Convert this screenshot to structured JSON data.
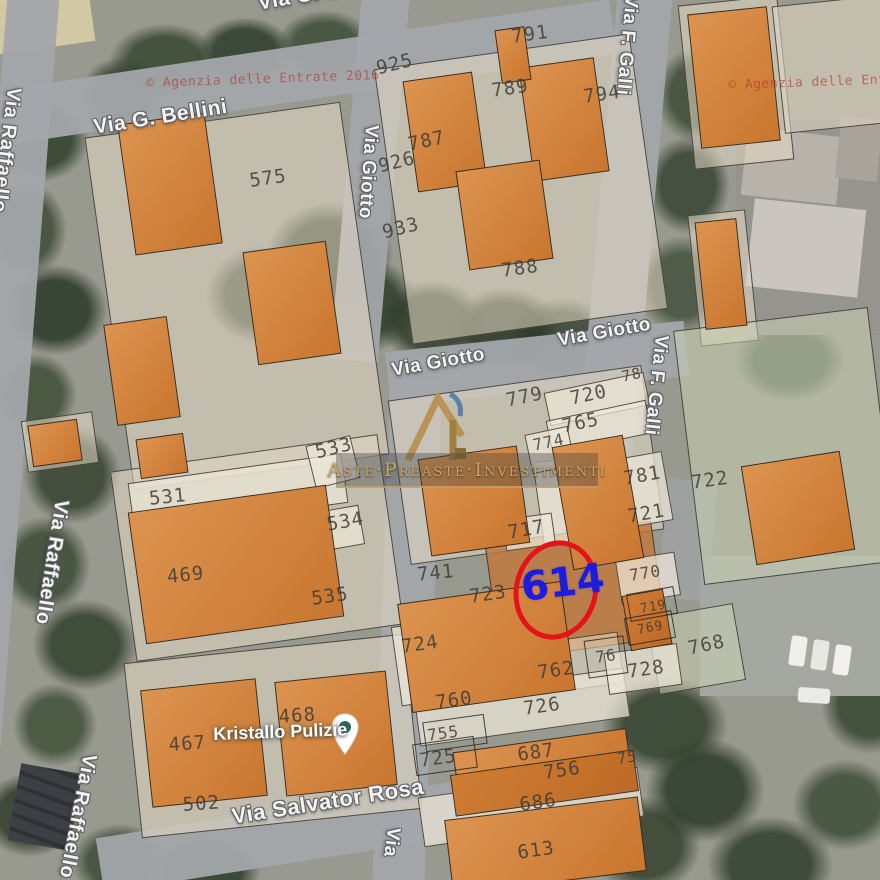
{
  "map_type": "cadastral-overlay-on-satellite",
  "highlight": {
    "parcel_number": "614",
    "circle_color": "#e41318",
    "number_color": "#1c1ce0"
  },
  "logo": {
    "text": "Aste·Preaste·Investimenti",
    "monogram": "R",
    "gold": "#c9a55e"
  },
  "watermark": {
    "text": "© Agenzia delle Entrate 2016",
    "color": "#b2342c",
    "positions": [
      {
        "x": 146,
        "y": 76,
        "r": -2
      },
      {
        "x": 728,
        "y": 78,
        "r": -2
      }
    ]
  },
  "poi": {
    "label": "Kristallo Pulizie",
    "icon": "map-pin",
    "x": 213,
    "y": 724,
    "r": -2
  },
  "colors": {
    "building": "#d5873f",
    "overlay": "#e5dbc6",
    "street": "#a3a6ab",
    "soil": "#c1783a"
  },
  "street_labels": [
    {
      "t": "Via G. Bellini",
      "x": 92,
      "y": 116,
      "r": -9,
      "s": 21
    },
    {
      "t": "Via G. Bellini",
      "x": 256,
      "y": -8,
      "r": -10,
      "s": 21
    },
    {
      "t": "Via Raffaello",
      "x": 2,
      "y": 86,
      "r": 7,
      "v": 1,
      "s": 20
    },
    {
      "t": "Via Raffaello",
      "x": 50,
      "y": 498,
      "r": 9,
      "v": 1,
      "s": 20
    },
    {
      "t": "Via Raffaello",
      "x": 78,
      "y": 752,
      "r": 11,
      "v": 1,
      "s": 20
    },
    {
      "t": "Via Giotto",
      "x": 360,
      "y": 124,
      "r": 4,
      "v": 1,
      "s": 19
    },
    {
      "t": "Via Giotto",
      "x": 390,
      "y": 360,
      "r": -10,
      "s": 19
    },
    {
      "t": "Via Giotto",
      "x": 556,
      "y": 330,
      "r": -10,
      "s": 19
    },
    {
      "t": "Via F. Galli",
      "x": 620,
      "y": -6,
      "r": 5,
      "v": 1,
      "s": 19
    },
    {
      "t": "Via F. Galli",
      "x": 650,
      "y": 334,
      "r": 6,
      "v": 1,
      "s": 19
    },
    {
      "t": "Via Salvator Rosa",
      "x": 230,
      "y": 804,
      "r": -9,
      "s": 22
    },
    {
      "t": "Via",
      "x": 382,
      "y": 826,
      "r": 7,
      "v": 1,
      "s": 19
    }
  ],
  "parcel_labels": [
    {
      "t": "575",
      "x": 248,
      "y": 170,
      "r": -8
    },
    {
      "t": "925",
      "x": 374,
      "y": 58,
      "r": -14
    },
    {
      "t": "791",
      "x": 510,
      "y": 26,
      "r": -8
    },
    {
      "t": "789",
      "x": 490,
      "y": 80,
      "r": -8
    },
    {
      "t": "794",
      "x": 582,
      "y": 86,
      "r": -8
    },
    {
      "t": "787",
      "x": 406,
      "y": 134,
      "r": -12
    },
    {
      "t": "926",
      "x": 376,
      "y": 156,
      "r": -14
    },
    {
      "t": "933",
      "x": 380,
      "y": 222,
      "r": -14
    },
    {
      "t": "788",
      "x": 500,
      "y": 260,
      "r": -8
    },
    {
      "t": "533",
      "x": 313,
      "y": 442,
      "r": -14
    },
    {
      "t": "531",
      "x": 148,
      "y": 488,
      "r": -6
    },
    {
      "t": "534",
      "x": 325,
      "y": 514,
      "r": -10
    },
    {
      "t": "469",
      "x": 166,
      "y": 566,
      "r": -6
    },
    {
      "t": "535",
      "x": 310,
      "y": 588,
      "r": -8
    },
    {
      "t": "78",
      "x": 620,
      "y": 368,
      "r": -12,
      "s": 15
    },
    {
      "t": "779",
      "x": 504,
      "y": 390,
      "r": -12
    },
    {
      "t": "720",
      "x": 568,
      "y": 388,
      "r": -12
    },
    {
      "t": "765",
      "x": 560,
      "y": 416,
      "r": -12
    },
    {
      "t": "774",
      "x": 531,
      "y": 436,
      "r": -12,
      "s": 16
    },
    {
      "t": "781",
      "x": 622,
      "y": 468,
      "r": -10
    },
    {
      "t": "722",
      "x": 690,
      "y": 472,
      "r": -8
    },
    {
      "t": "721",
      "x": 626,
      "y": 506,
      "r": -10
    },
    {
      "t": "717",
      "x": 506,
      "y": 522,
      "r": -10
    },
    {
      "t": "741",
      "x": 416,
      "y": 564,
      "r": -6
    },
    {
      "t": "770",
      "x": 628,
      "y": 566,
      "r": -9,
      "s": 16
    },
    {
      "t": "723",
      "x": 468,
      "y": 586,
      "r": -8
    },
    {
      "t": "719",
      "x": 639,
      "y": 602,
      "r": -10,
      "s": 13
    },
    {
      "t": "769",
      "x": 636,
      "y": 623,
      "r": -10,
      "s": 13
    },
    {
      "t": "724",
      "x": 400,
      "y": 636,
      "r": -8
    },
    {
      "t": "768",
      "x": 686,
      "y": 638,
      "r": -12
    },
    {
      "t": "76",
      "x": 594,
      "y": 648,
      "r": -8,
      "s": 16
    },
    {
      "t": "762",
      "x": 536,
      "y": 662,
      "r": -8
    },
    {
      "t": "728",
      "x": 626,
      "y": 661,
      "r": -8
    },
    {
      "t": "760",
      "x": 434,
      "y": 692,
      "r": -8
    },
    {
      "t": "726",
      "x": 522,
      "y": 698,
      "r": -8
    },
    {
      "t": "468",
      "x": 278,
      "y": 706,
      "r": -4
    },
    {
      "t": "755",
      "x": 426,
      "y": 726,
      "r": -8,
      "s": 16
    },
    {
      "t": "467",
      "x": 168,
      "y": 734,
      "r": -4
    },
    {
      "t": "687",
      "x": 516,
      "y": 744,
      "r": -8
    },
    {
      "t": "725",
      "x": 418,
      "y": 750,
      "r": -8
    },
    {
      "t": "75",
      "x": 616,
      "y": 750,
      "r": -8,
      "s": 15
    },
    {
      "t": "756",
      "x": 542,
      "y": 762,
      "r": -8
    },
    {
      "t": "686",
      "x": 518,
      "y": 794,
      "r": -8
    },
    {
      "t": "502",
      "x": 182,
      "y": 794,
      "r": -4
    },
    {
      "t": "613",
      "x": 516,
      "y": 842,
      "r": -8
    }
  ]
}
